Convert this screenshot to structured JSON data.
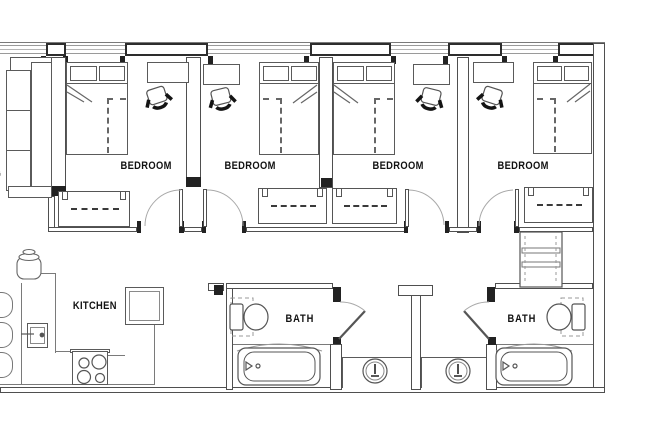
{
  "colors": {
    "background": "#ffffff",
    "wall_line": "#4f4f4f",
    "thick_exterior_wall": "#2d2d2d",
    "light_line": "#9a9a9a",
    "fixture_line": "#5a5a5a",
    "door_arc": "#a9a9a9",
    "black_fill": "#222222",
    "text": "#111111"
  },
  "rooms": {
    "bedrooms": [
      {
        "label": "BEDROOM"
      },
      {
        "label": "BEDROOM"
      },
      {
        "label": "BEDROOM"
      },
      {
        "label": "BEDROOM"
      }
    ],
    "kitchen": {
      "label": "KITCHEN"
    },
    "baths": [
      {
        "label": "BATH"
      },
      {
        "label": "BATH"
      }
    ],
    "living": {
      "label_fragment": "G"
    }
  }
}
